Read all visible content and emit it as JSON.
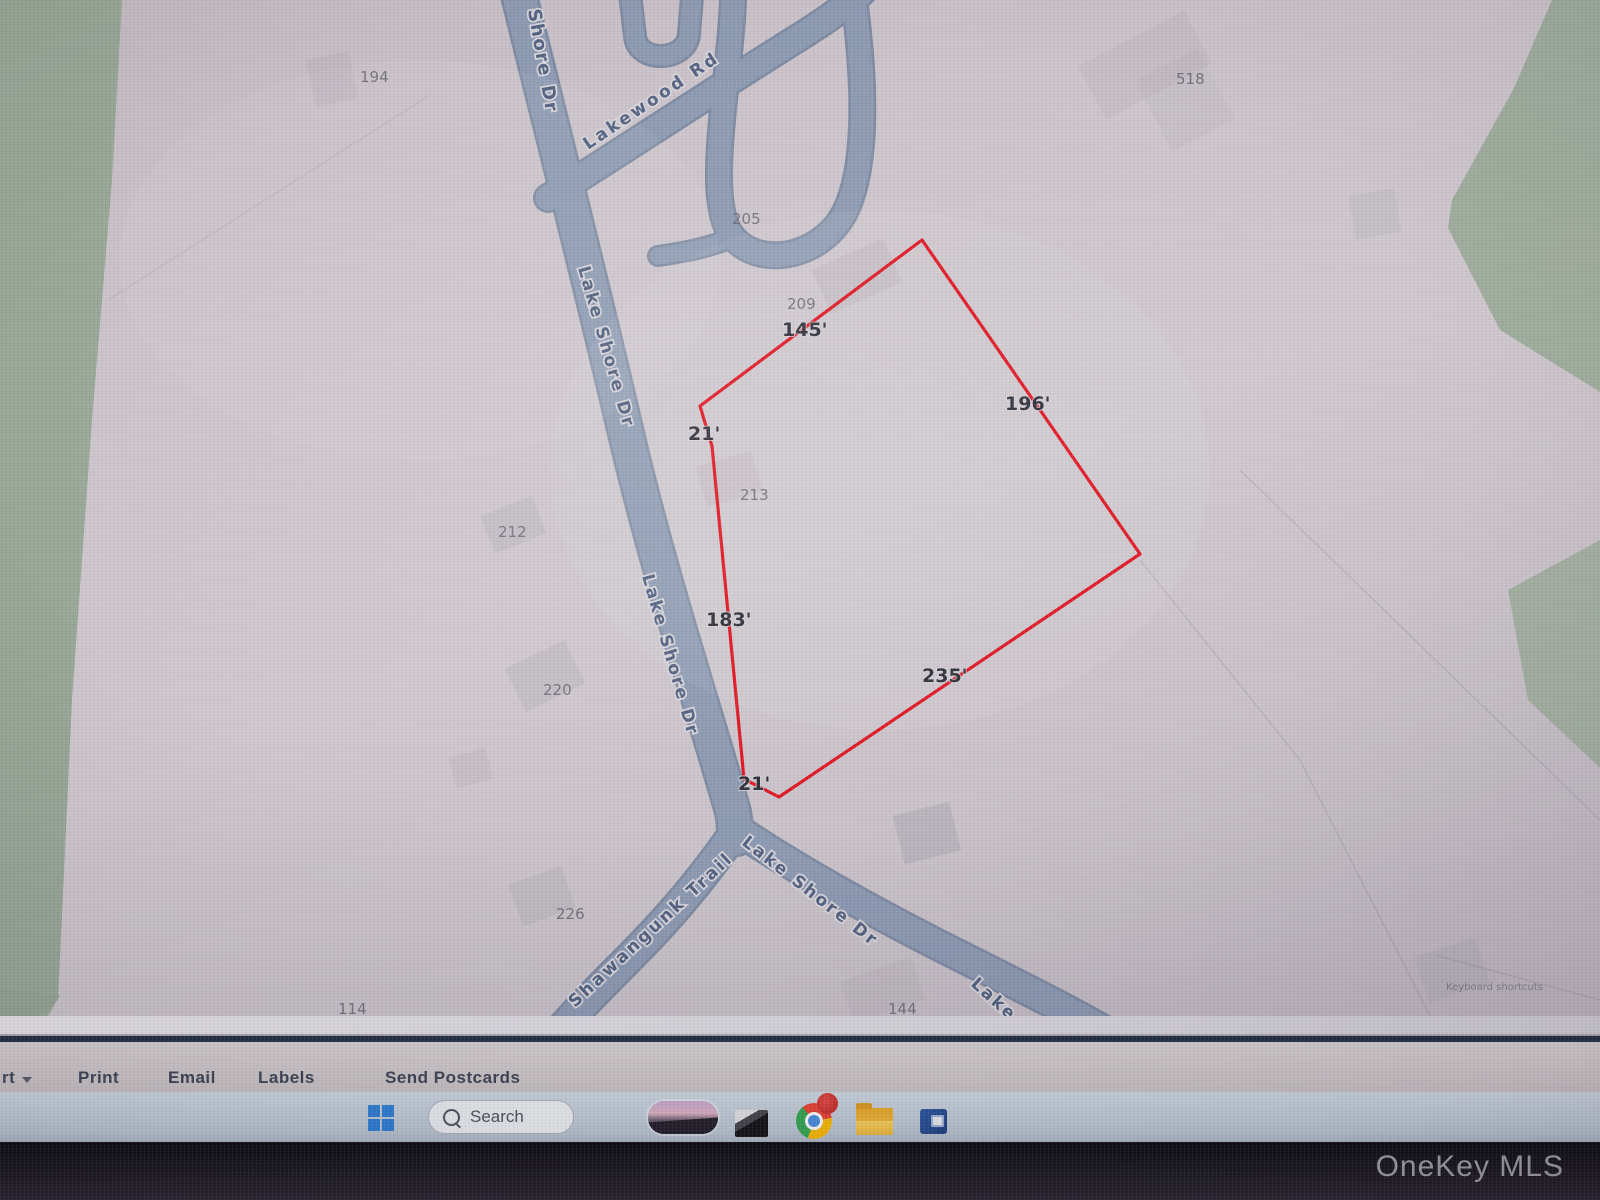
{
  "colors": {
    "parcel_outline": "#e0121f",
    "road": "#8b99b2",
    "green_area": "#95a593",
    "map_background": "#cbc3ca",
    "toolbar_bg": "#cfc9cb",
    "taskbar_bg": "#c2cdd8"
  },
  "map": {
    "road_labels": [
      {
        "text": "Shore Dr"
      },
      {
        "text": "Lake Shore Dr"
      },
      {
        "text": "Lake Shore Dr"
      },
      {
        "text": "Lakewood Rd"
      },
      {
        "text": "Shawangunk Trail"
      },
      {
        "text": "Lake Shore Dr"
      },
      {
        "text": "Lake"
      }
    ],
    "lot_numbers": [
      {
        "text": "194"
      },
      {
        "text": "205"
      },
      {
        "text": "209"
      },
      {
        "text": "213"
      },
      {
        "text": "212"
      },
      {
        "text": "220"
      },
      {
        "text": "226"
      },
      {
        "text": "518"
      },
      {
        "text": "114"
      },
      {
        "text": "144"
      }
    ],
    "parcel_dimensions": [
      {
        "text": "145'"
      },
      {
        "text": "21'"
      },
      {
        "text": "183'"
      },
      {
        "text": "21'"
      },
      {
        "text": "235'"
      },
      {
        "text": "196'"
      }
    ],
    "attribution": "Keyboard shortcuts"
  },
  "toolbar": {
    "partial_item_label": "rt",
    "items": [
      "Print",
      "Email",
      "Labels",
      "Send Postcards"
    ]
  },
  "taskbar": {
    "search_label": "Search"
  },
  "watermark": "OneKey MLS"
}
